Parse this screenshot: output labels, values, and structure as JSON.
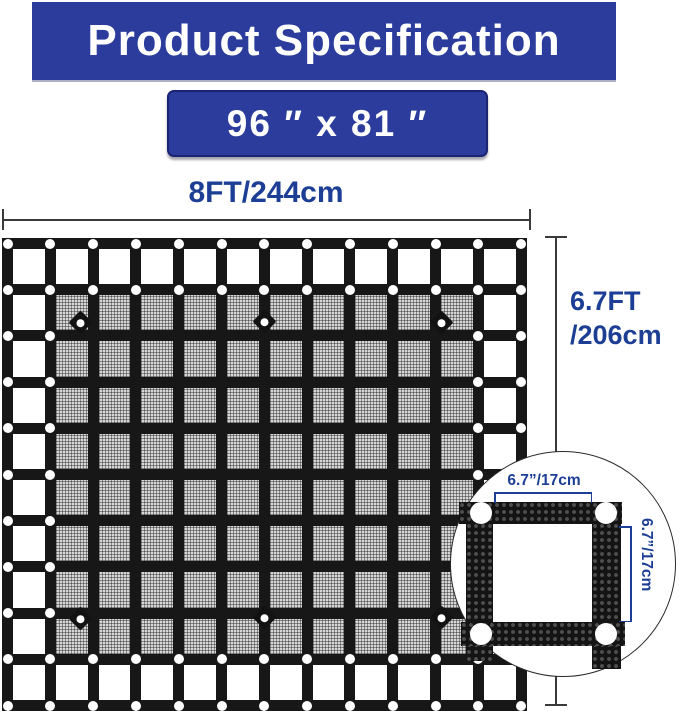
{
  "header": {
    "title": "Product Specification",
    "size_label": "96 ″ x 81 ″"
  },
  "dims": {
    "width_label": "8FT/244cm",
    "height_line1": "6.7FT",
    "height_line2": "/206cm"
  },
  "inset": {
    "mesh_width_label": "6.7”/17cm",
    "mesh_height_label": "6.7”/17cm"
  },
  "net": {
    "x0": 2,
    "y0": 238,
    "pitch_x": 42.8,
    "pitch_y": 46.2,
    "strap_w": 11,
    "v_straps": 13,
    "h_straps": 11,
    "grid_cells": "12 x 10",
    "mesh_rows": [
      1,
      8
    ],
    "mesh_cols": [
      1,
      10
    ],
    "grommet_d": 10,
    "attachment_points": [
      [
        80,
        322
      ],
      [
        264,
        321
      ],
      [
        441,
        322
      ],
      [
        80,
        618
      ],
      [
        264,
        617
      ],
      [
        441,
        617
      ]
    ]
  },
  "colors": {
    "banner_blue": "#2b3c9c",
    "banner_border": "#1a2473",
    "dimension_navy": "#1d3e95",
    "strap_black": "#171717",
    "mesh_gray": "#d6d6d6",
    "line_gray": "#3a3a3a",
    "background": "#ffffff"
  }
}
